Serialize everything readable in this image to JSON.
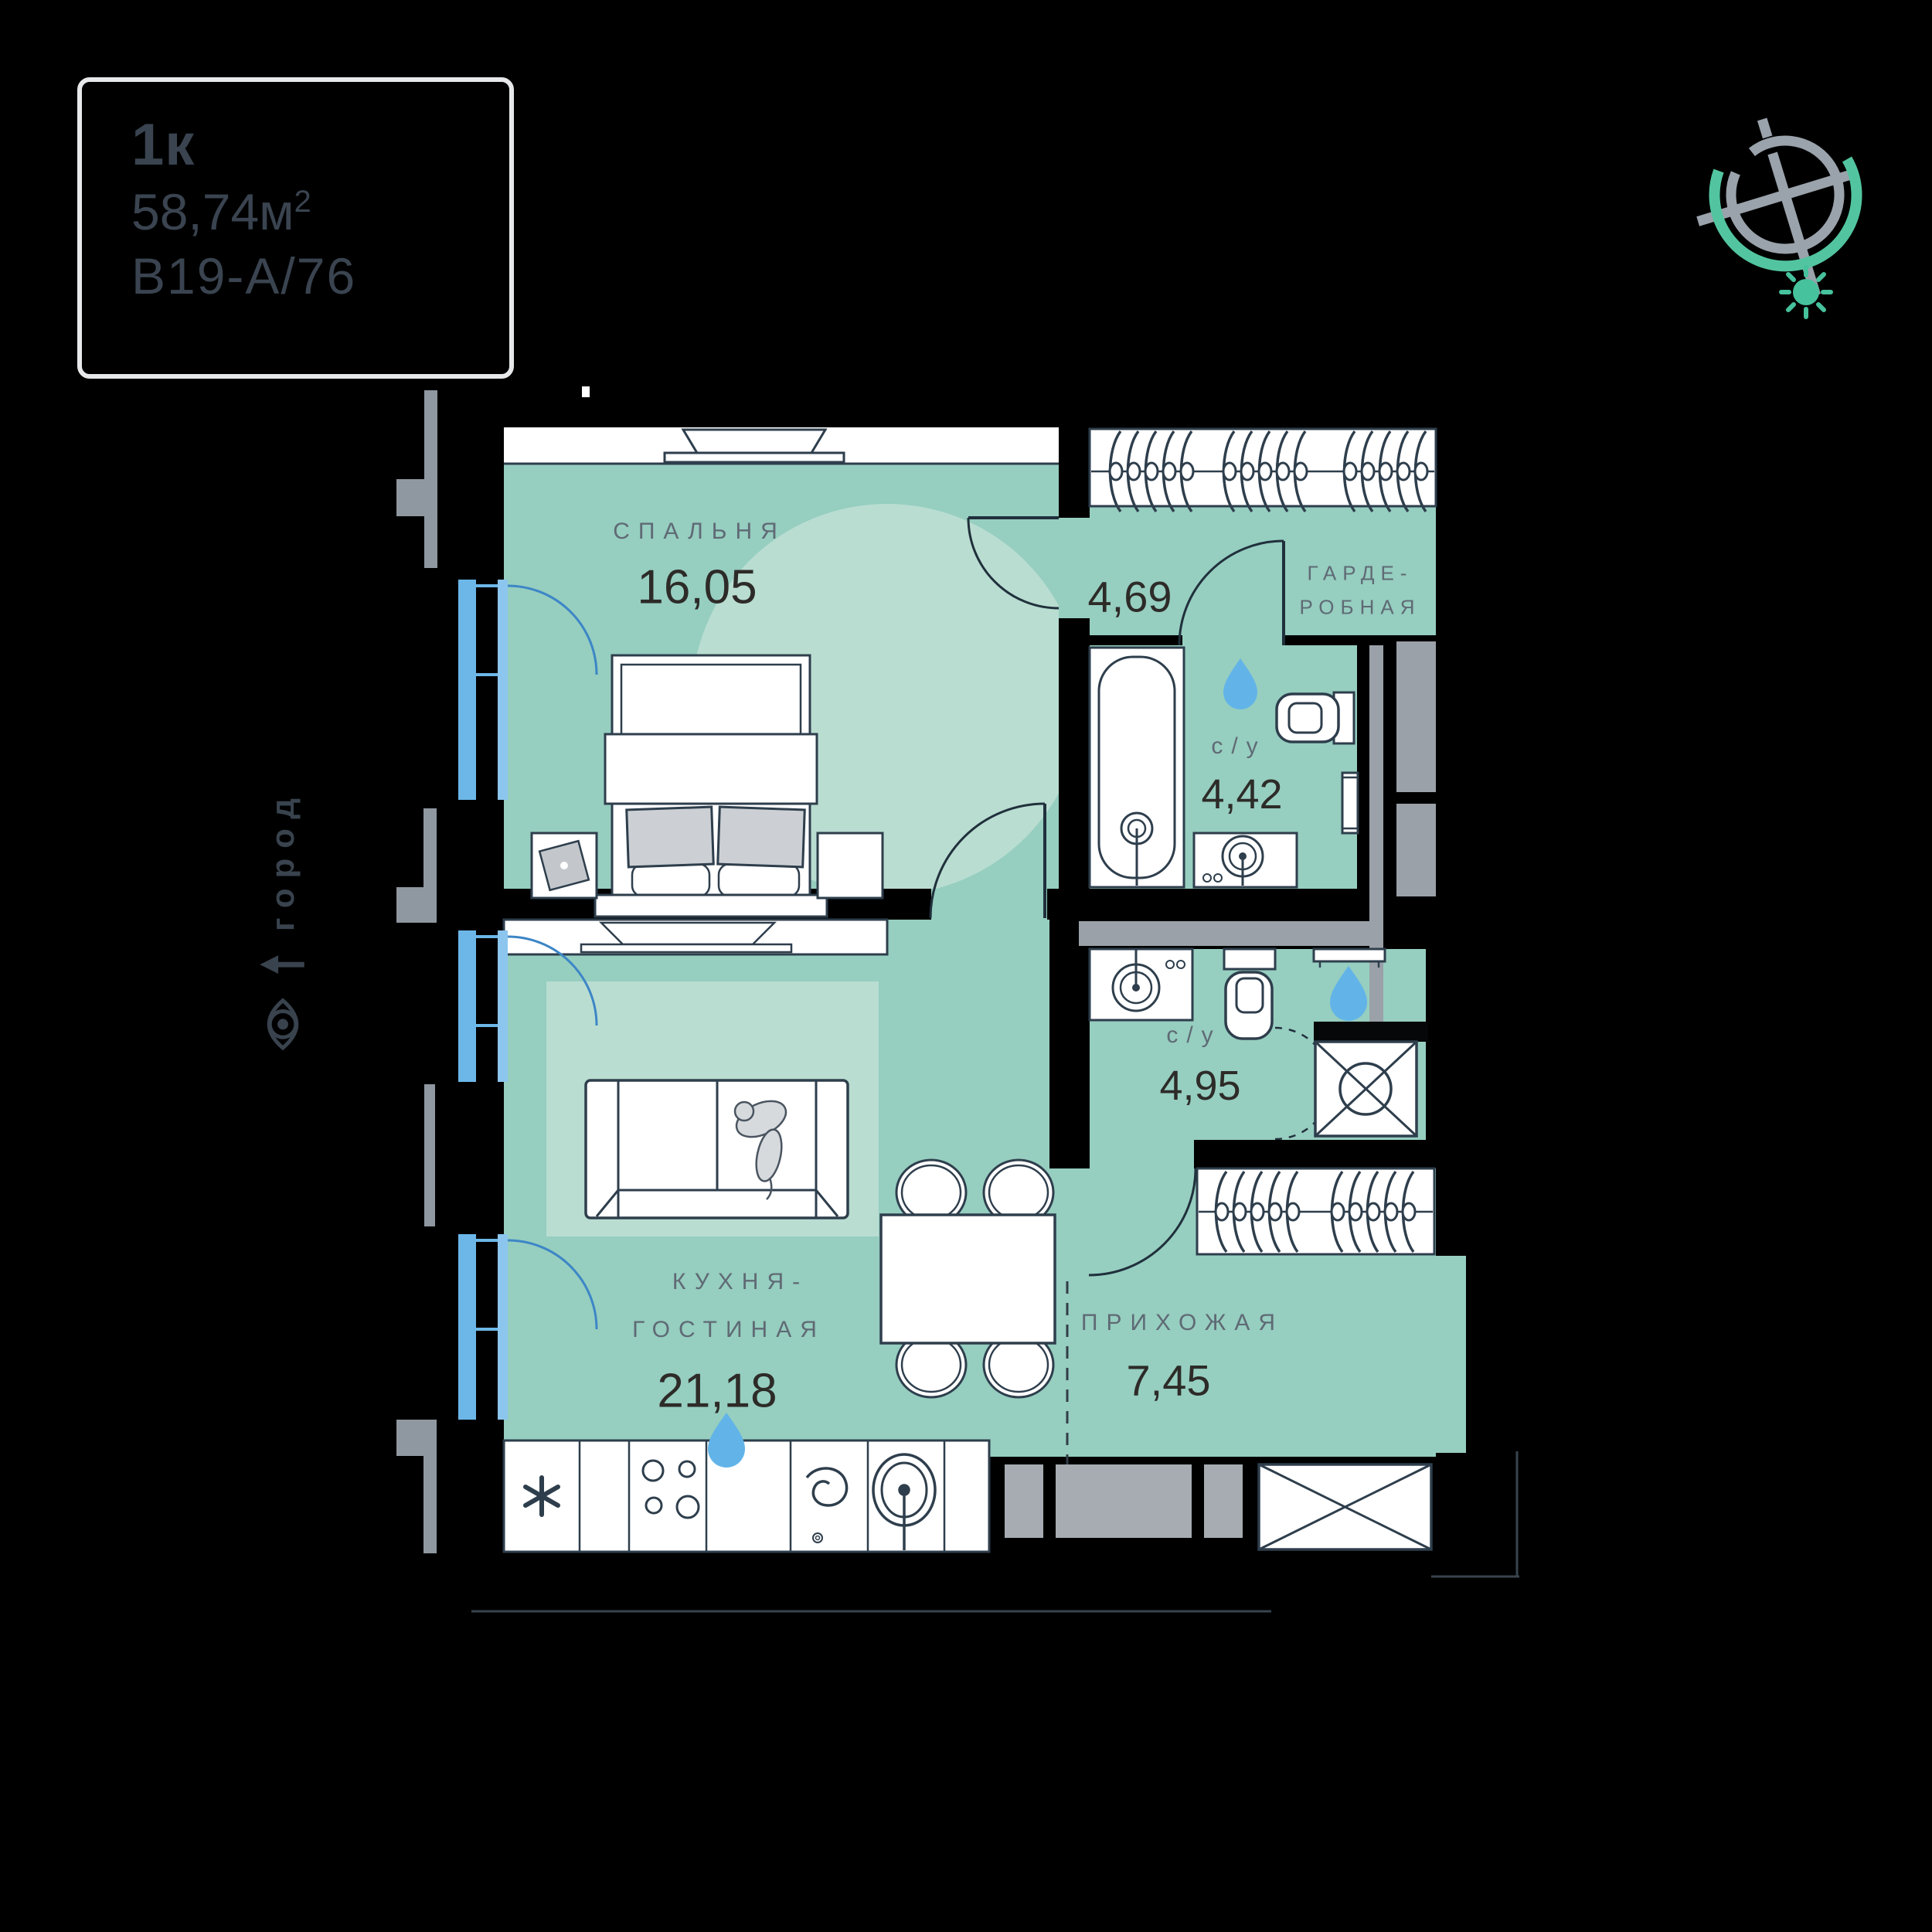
{
  "info_box": {
    "type": "1к",
    "area_value": "58,74",
    "area_unit": "м",
    "area_exp": "2",
    "plan_code": "В19-А/76"
  },
  "orientation": {
    "label": "город"
  },
  "rooms": {
    "bedroom": {
      "name": "СПАЛЬНЯ",
      "area": "16,05"
    },
    "hall": {
      "area": "4,69"
    },
    "wardrobe": {
      "line1": "ГАРДЕ-",
      "line2": "РОБНАЯ"
    },
    "bath_top": {
      "name": "с/у",
      "area": "4,42"
    },
    "bath_bottom": {
      "name": "с/у",
      "area": "4,95"
    },
    "kitchen": {
      "line1": "КУХНЯ-",
      "line2": "ГОСТИНАЯ",
      "area": "21,18"
    },
    "hallway": {
      "name": "ПРИХОЖАЯ",
      "area": "7,45"
    }
  },
  "colors": {
    "room_green": "#96cec0",
    "room_light": "#b9ddd1",
    "outline_dark": "#2e3e4c",
    "label_gray": "#5f6a74",
    "number_dark": "#2d2b28",
    "window_blue": "#6cb7e8",
    "window_blue_light": "#8cc6ee",
    "door_arc_blue": "#3d86c6",
    "drop_blue": "#62b4e8",
    "entry_gray": "#a6acb1",
    "balcony_gray": "#8f97a0",
    "compass_gray": "#9aa2ab",
    "compass_green": "#52c5a0",
    "box_border": "#e6e8e9",
    "box_text": "#3a4450"
  },
  "icons": {
    "compass": "compass-rose",
    "sun": "sun",
    "eye": "eye",
    "arrow": "up-arrow",
    "water_drop": "water-drop",
    "fridge": "asterisk-fridge",
    "stove": "burners",
    "hood": "swirl",
    "sink": "kitchen-sink"
  }
}
